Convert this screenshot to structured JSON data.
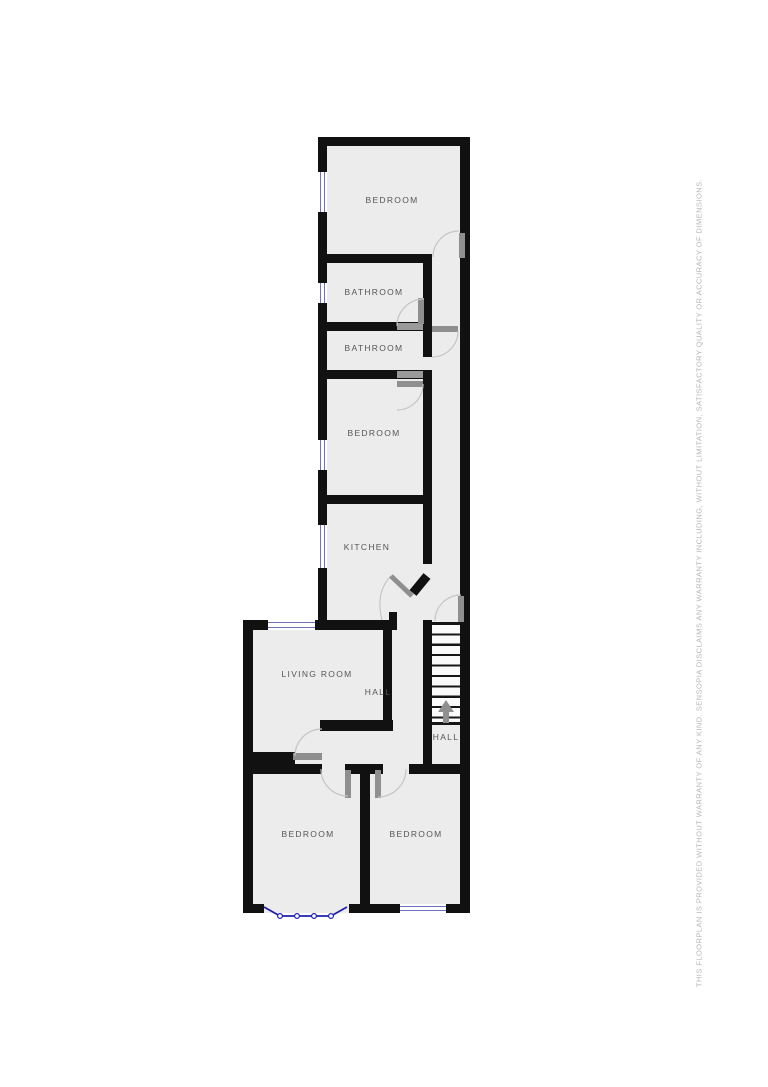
{
  "disclaimer": "THIS FLOORPLAN IS PROVIDED WITHOUT WARRANTY OF ANY KIND. SENSOPIA DISCLAIMS ANY WARRANTY INCLUDING, WITHOUT LIMITATION, SATISFACTORY QUALITY OR ACCURACY OF DIMENSIONS.",
  "colors": {
    "wall": "#111111",
    "floor": "#ececec",
    "window_frame": "#7070bd",
    "bay_window": "#2020b0",
    "door_leaf": "#8f8f8f",
    "door_arc": "#c4c4c4",
    "room_label": "#555555",
    "disclaimer_text": "#b5b5b5",
    "stairs_arrow": "#8f8f8f"
  },
  "rooms": {
    "bedroom_top": {
      "label": "BEDROOM"
    },
    "bathroom_upper": {
      "label": "BATHROOM"
    },
    "bathroom_lower": {
      "label": "BATHROOM"
    },
    "bedroom_mid": {
      "label": "BEDROOM"
    },
    "kitchen": {
      "label": "KITCHEN"
    },
    "living_room": {
      "label": "LIVING ROOM"
    },
    "hall_main": {
      "label": "HALL"
    },
    "hall_landing": {
      "label": "HALL"
    },
    "bedroom_bottom_left": {
      "label": "BEDROOM"
    },
    "bedroom_bottom_right": {
      "label": "BEDROOM"
    }
  }
}
